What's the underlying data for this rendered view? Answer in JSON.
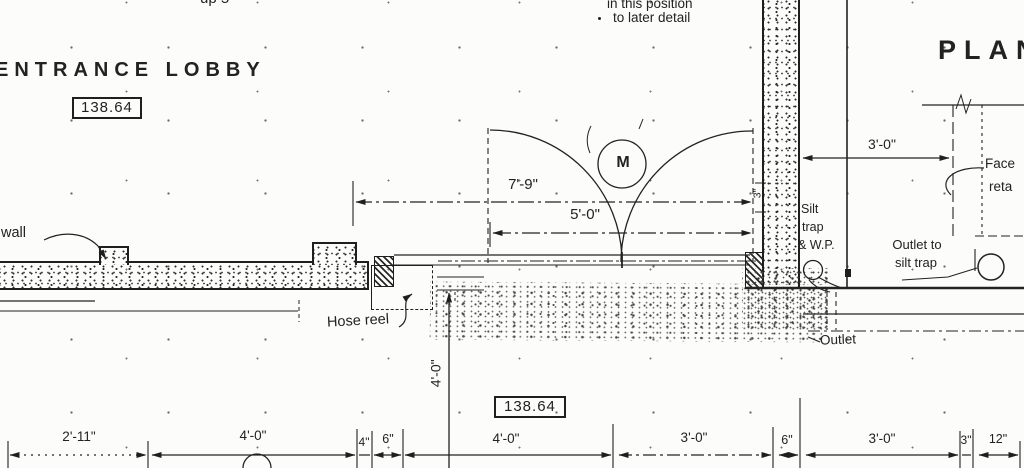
{
  "colors": {
    "ink": "#1f1f1f",
    "paper": "#fcfcfa"
  },
  "header": {
    "plan_title": "PLAN",
    "up_note": "up 5",
    "position_note_1": "in this position",
    "position_note_2": "to later detail"
  },
  "room": {
    "name": "ENTRANCE LOBBY",
    "level": "138.64"
  },
  "floor": {
    "level": "138.64"
  },
  "labels": {
    "wall": "wall",
    "hose_reel": "Hose reel",
    "silt_trap_1": "Silt",
    "silt_trap_2": "trap",
    "silt_trap_3": "& W.P.",
    "outlet_to_1": "Outlet to",
    "outlet_to_2": "silt trap",
    "outlet": "Outlet",
    "face_1": "Face",
    "face_2": "reta",
    "door_mark": "M"
  },
  "dimensions": {
    "door_opening": "7'-9\"",
    "door_leaf": "5'-0\"",
    "wall_offset": "3'-0\"",
    "apron_depth": "4'-0\"",
    "wall_gap": "3\"",
    "bottom_chain": [
      {
        "label": "2'-11\""
      },
      {
        "label": "4'-0\""
      },
      {
        "label": "4\""
      },
      {
        "label": "6\""
      },
      {
        "label": "4'-0\""
      },
      {
        "label": "3'-0\""
      },
      {
        "label": "6\""
      },
      {
        "label": "3'-0\""
      },
      {
        "label": "3\""
      },
      {
        "label": "12\""
      }
    ]
  }
}
